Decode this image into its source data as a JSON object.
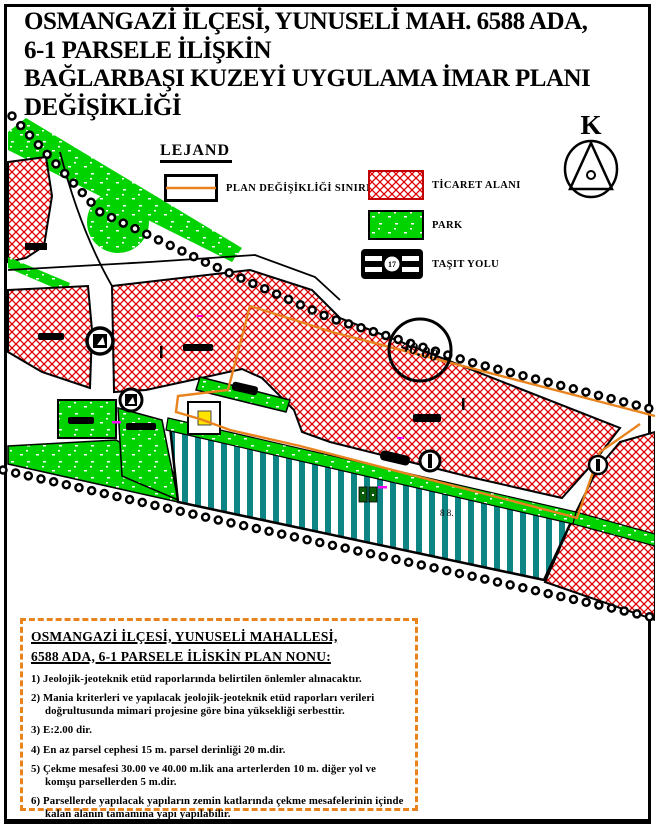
{
  "title": {
    "line1": "OSMANGAZİ İLÇESİ, YUNUSELİ MAH. 6588 ADA,",
    "line2": "6-1 PARSELE İLİŞKİN",
    "line3": "BAĞLARBAŞI KUZEYİ UYGULAMA İMAR PLANI",
    "line4": "DEĞİŞİKLİĞİ"
  },
  "legend": {
    "title": "LEJAND",
    "items": [
      {
        "label": "PLAN DEĞİŞİKLİĞİ SINIRI",
        "swatch": "plan-boundary-box",
        "color": "#e8831e"
      },
      {
        "label": "TİCARET ALANI",
        "swatch": "red-crosshatch",
        "color": "#dd0000"
      },
      {
        "label": "PARK",
        "swatch": "green-speckled",
        "color": "#00d300"
      },
      {
        "label": "TAŞIT YOLU",
        "swatch": "road-symbol",
        "road_symbol_text": "17"
      }
    ]
  },
  "north_arrow": {
    "label": "K"
  },
  "map": {
    "road_width_label": "40.00",
    "parcel_label": "8 8.",
    "colors": {
      "commercial_hatch": "#dd0000",
      "park_green": "#00d300",
      "parcel_teal": "#0e8585",
      "plan_boundary_orange": "#e8831e",
      "survey_tick_magenta": "#ff00ff",
      "transformer_yellow": "#ffe400"
    }
  },
  "notes": {
    "heading_line1": "OSMANGAZİ İLÇESİ, YUNUSELİ MAHALLESİ,",
    "heading_line2": "6588 ADA, 6-1 PARSELE İLİSKİN PLAN NONU:",
    "items": [
      {
        "num": "1)",
        "text": "Jeolojik-jeoteknik etüd raporlarında belirtilen önlemler alınacaktır."
      },
      {
        "num": "2)",
        "text": "Mania kriterleri ve yapılacak jeolojik-jeoteknik etüd raporları verileri doğrultusunda mimari projesine göre bina yüksekliği serbesttir."
      },
      {
        "num": "3)",
        "text": "E:2.00 dir."
      },
      {
        "num": "4)",
        "text": "En az parsel cephesi 15 m. parsel derinliği 20 m.dir."
      },
      {
        "num": "5)",
        "text": "Çekme mesafesi 30.00 ve 40.00 m.lik ana arterlerden 10 m. diğer yol ve komşu parsellerden 5 m.dir."
      },
      {
        "num": "6)",
        "text": "Parsellerde yapılacak yapıların zemin katlarında çekme mesafelerinin içinde kalan alanın tamamına yapı yapılabilir."
      }
    ]
  }
}
